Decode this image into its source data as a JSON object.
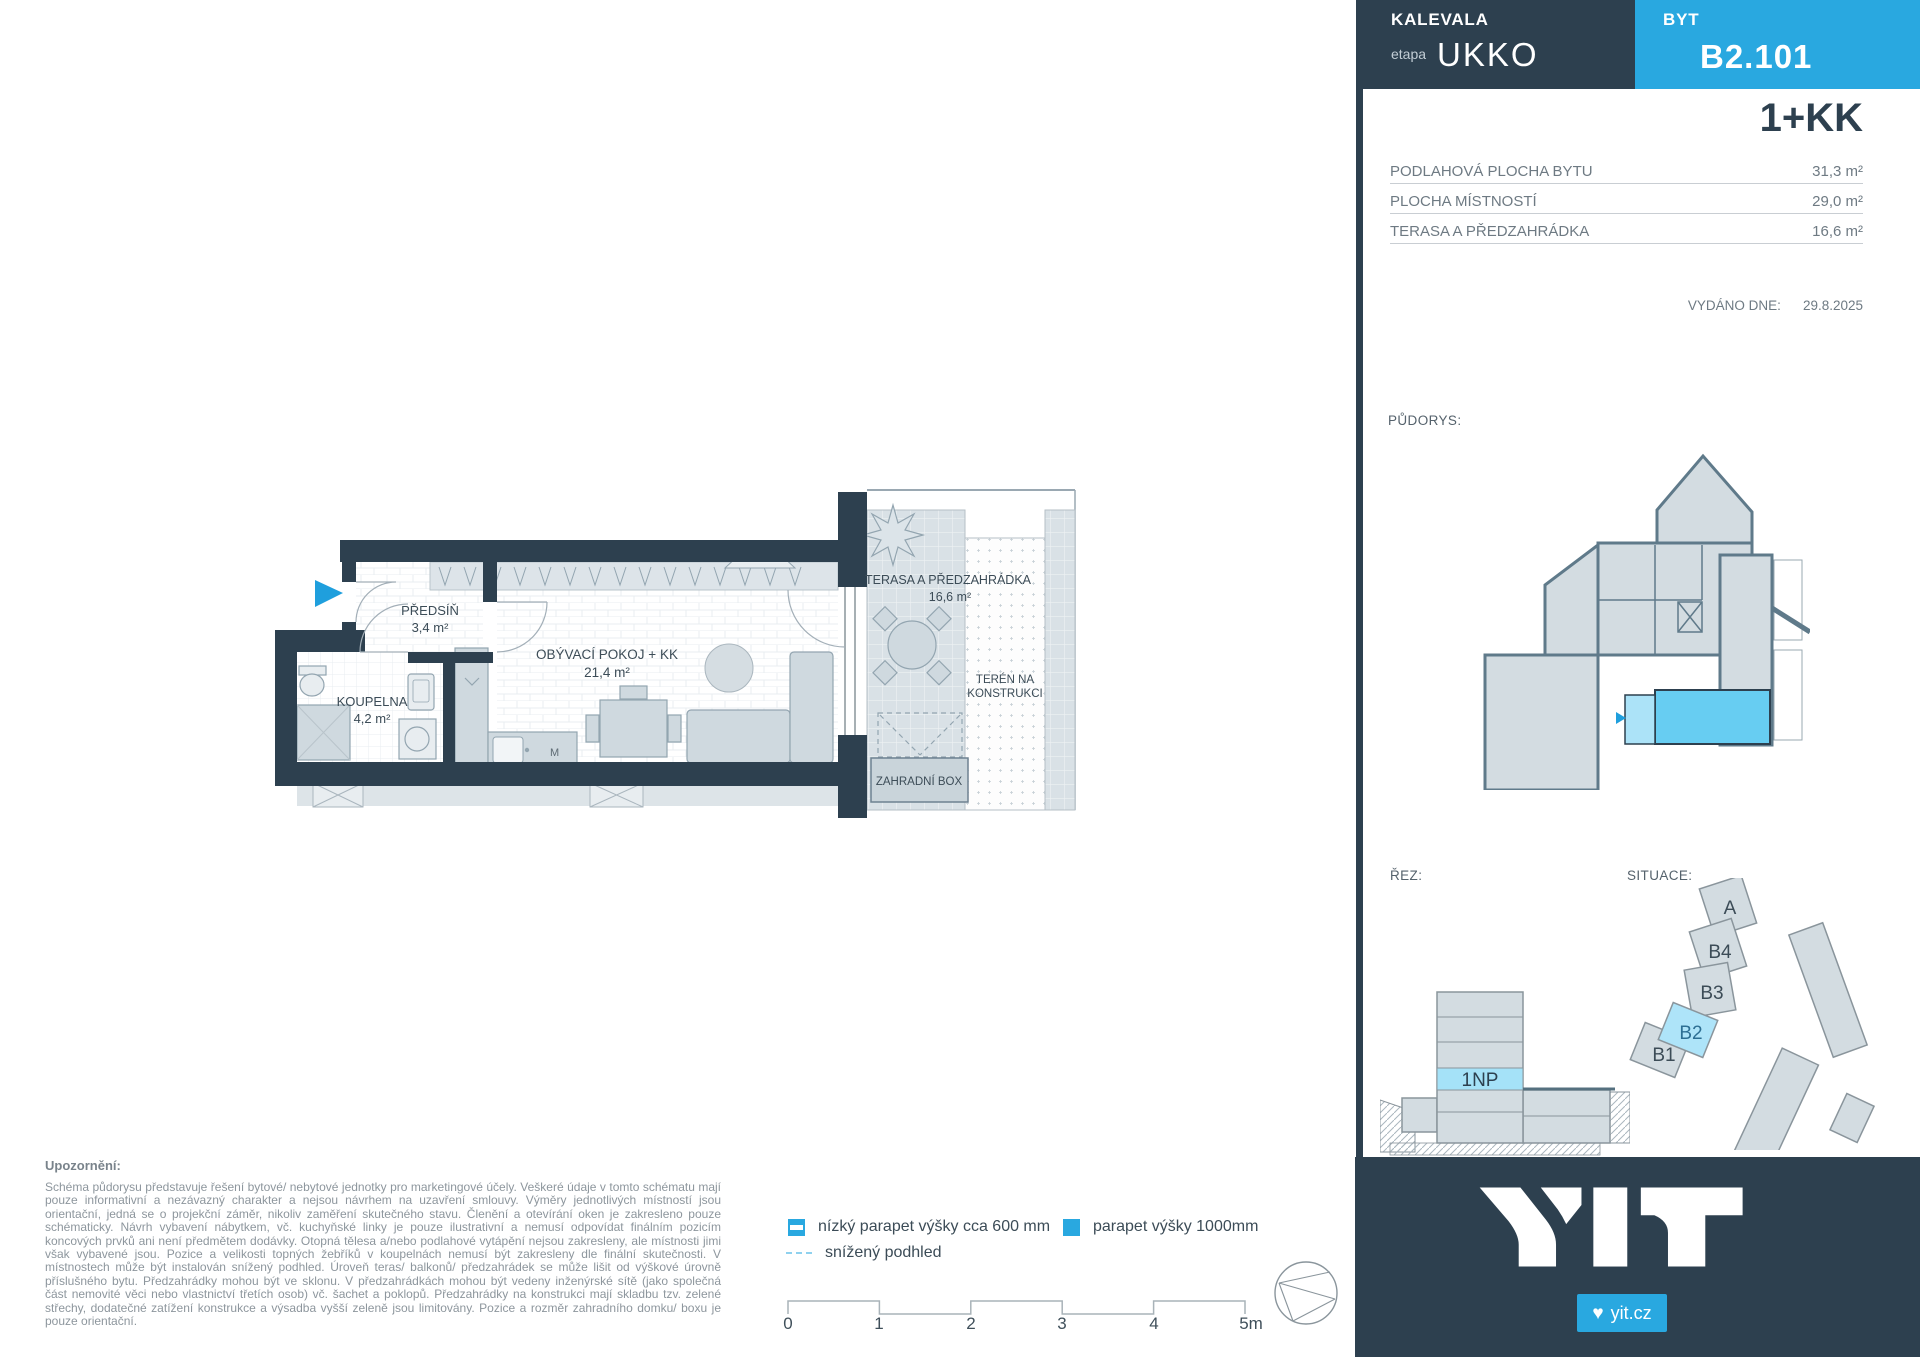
{
  "project": {
    "name": "KALEVALA",
    "etapa_label": "etapa",
    "etapa_value": "UKKO",
    "unit_label": "BYT",
    "unit_code": "B2.101",
    "layout_type": "1+KK"
  },
  "areas": {
    "rows": [
      {
        "label": "PODLAHOVÁ PLOCHA BYTU",
        "value": "31,3 m²"
      },
      {
        "label": "PLOCHA MÍSTNOSTÍ",
        "value": "29,0 m²"
      },
      {
        "label": "TERASA A PŘEDZAHRÁDKA",
        "value": "16,6 m²"
      }
    ]
  },
  "issued": {
    "label": "VYDÁNO DNE:",
    "date": "29.8.2025"
  },
  "section_labels": {
    "floorplan": "PŮDORYS:",
    "section": "ŘEZ:",
    "situation": "SITUACE:"
  },
  "rez": {
    "highlight_floor": "1NP"
  },
  "situace": {
    "buildings": [
      "A",
      "B4",
      "B3",
      "B2",
      "B1"
    ]
  },
  "plan": {
    "rooms": [
      {
        "name": "PŘEDSÍŇ",
        "area": "3,4 m²"
      },
      {
        "name": "KOUPELNA",
        "area": "4,2 m²"
      },
      {
        "name": "OBÝVACÍ POKOJ + KK",
        "area": "21,4 m²"
      },
      {
        "name": "TERASA A PŘEDZAHRÁDKA",
        "area": "16,6 m²"
      }
    ],
    "teren_line1": "TERÉN NA",
    "teren_line2": "KONSTRUKCI",
    "garden_box": "ZAHRADNÍ BOX",
    "kitchen_mark": "M"
  },
  "legend": {
    "items": [
      {
        "label": "nízký parapet výšky cca 600 mm"
      },
      {
        "label": "parapet výšky 1000mm"
      },
      {
        "label": "snížený podhled"
      }
    ]
  },
  "scalebar": {
    "ticks": [
      "0",
      "1",
      "2",
      "3",
      "4",
      "5m"
    ]
  },
  "note": {
    "title": "Upozornění:",
    "body": "Schéma půdorysu představuje řešení bytové/ nebytové jednotky pro marketingové účely. Veškeré údaje v tomto schématu mají pouze informativní a nezávazný charakter a nejsou návrhem na uzavření smlouvy. Výměry jednotlivých místností jsou orientační, jedná se o projekční záměr, nikoliv zaměření skutečného stavu. Členění a otevírání oken je zakresleno pouze schématicky. Návrh vybavení nábytkem, vč. kuchyňské linky je pouze ilustrativní a nemusí odpovídat finálním pozicím koncových prvků ani není předmětem dodávky. Otopná tělesa a/nebo podlahové vytápění nejsou zakresleny, ale místnosti jimi však vybavené jsou. Pozice a velikosti topných žebříků v koupelnách nemusí být zakresleny dle finální skutečnosti. V místnostech může být instalován snížený podhled. Úroveň teras/ balkonů/ předzahrádek se může lišit od výškové úrovně příslušného bytu. Předzahrádky mohou být ve sklonu. V předzahrádkách mohou být vedeny inženýrské sítě (jako společná část nemovité věci nebo vlastnictví třetích osob) vč. šachet a poklopů. Předzahrádky na konstrukci mají skladbu tzv. zelené střechy, dodatečné zatížení konstrukce a výsadba vyšší zeleně jsou limitovány. Pozice a rozměr zahradního domku/ boxu je pouze orientační."
  },
  "footer": {
    "site": "yit.cz",
    "heart": "♥"
  },
  "colors": {
    "dark": "#2d404f",
    "accent_blue": "#29a8e0",
    "highlight_blue": "#67cdf2",
    "light_blue": "#a5e2f8",
    "building_gray": "#d3dce1"
  }
}
